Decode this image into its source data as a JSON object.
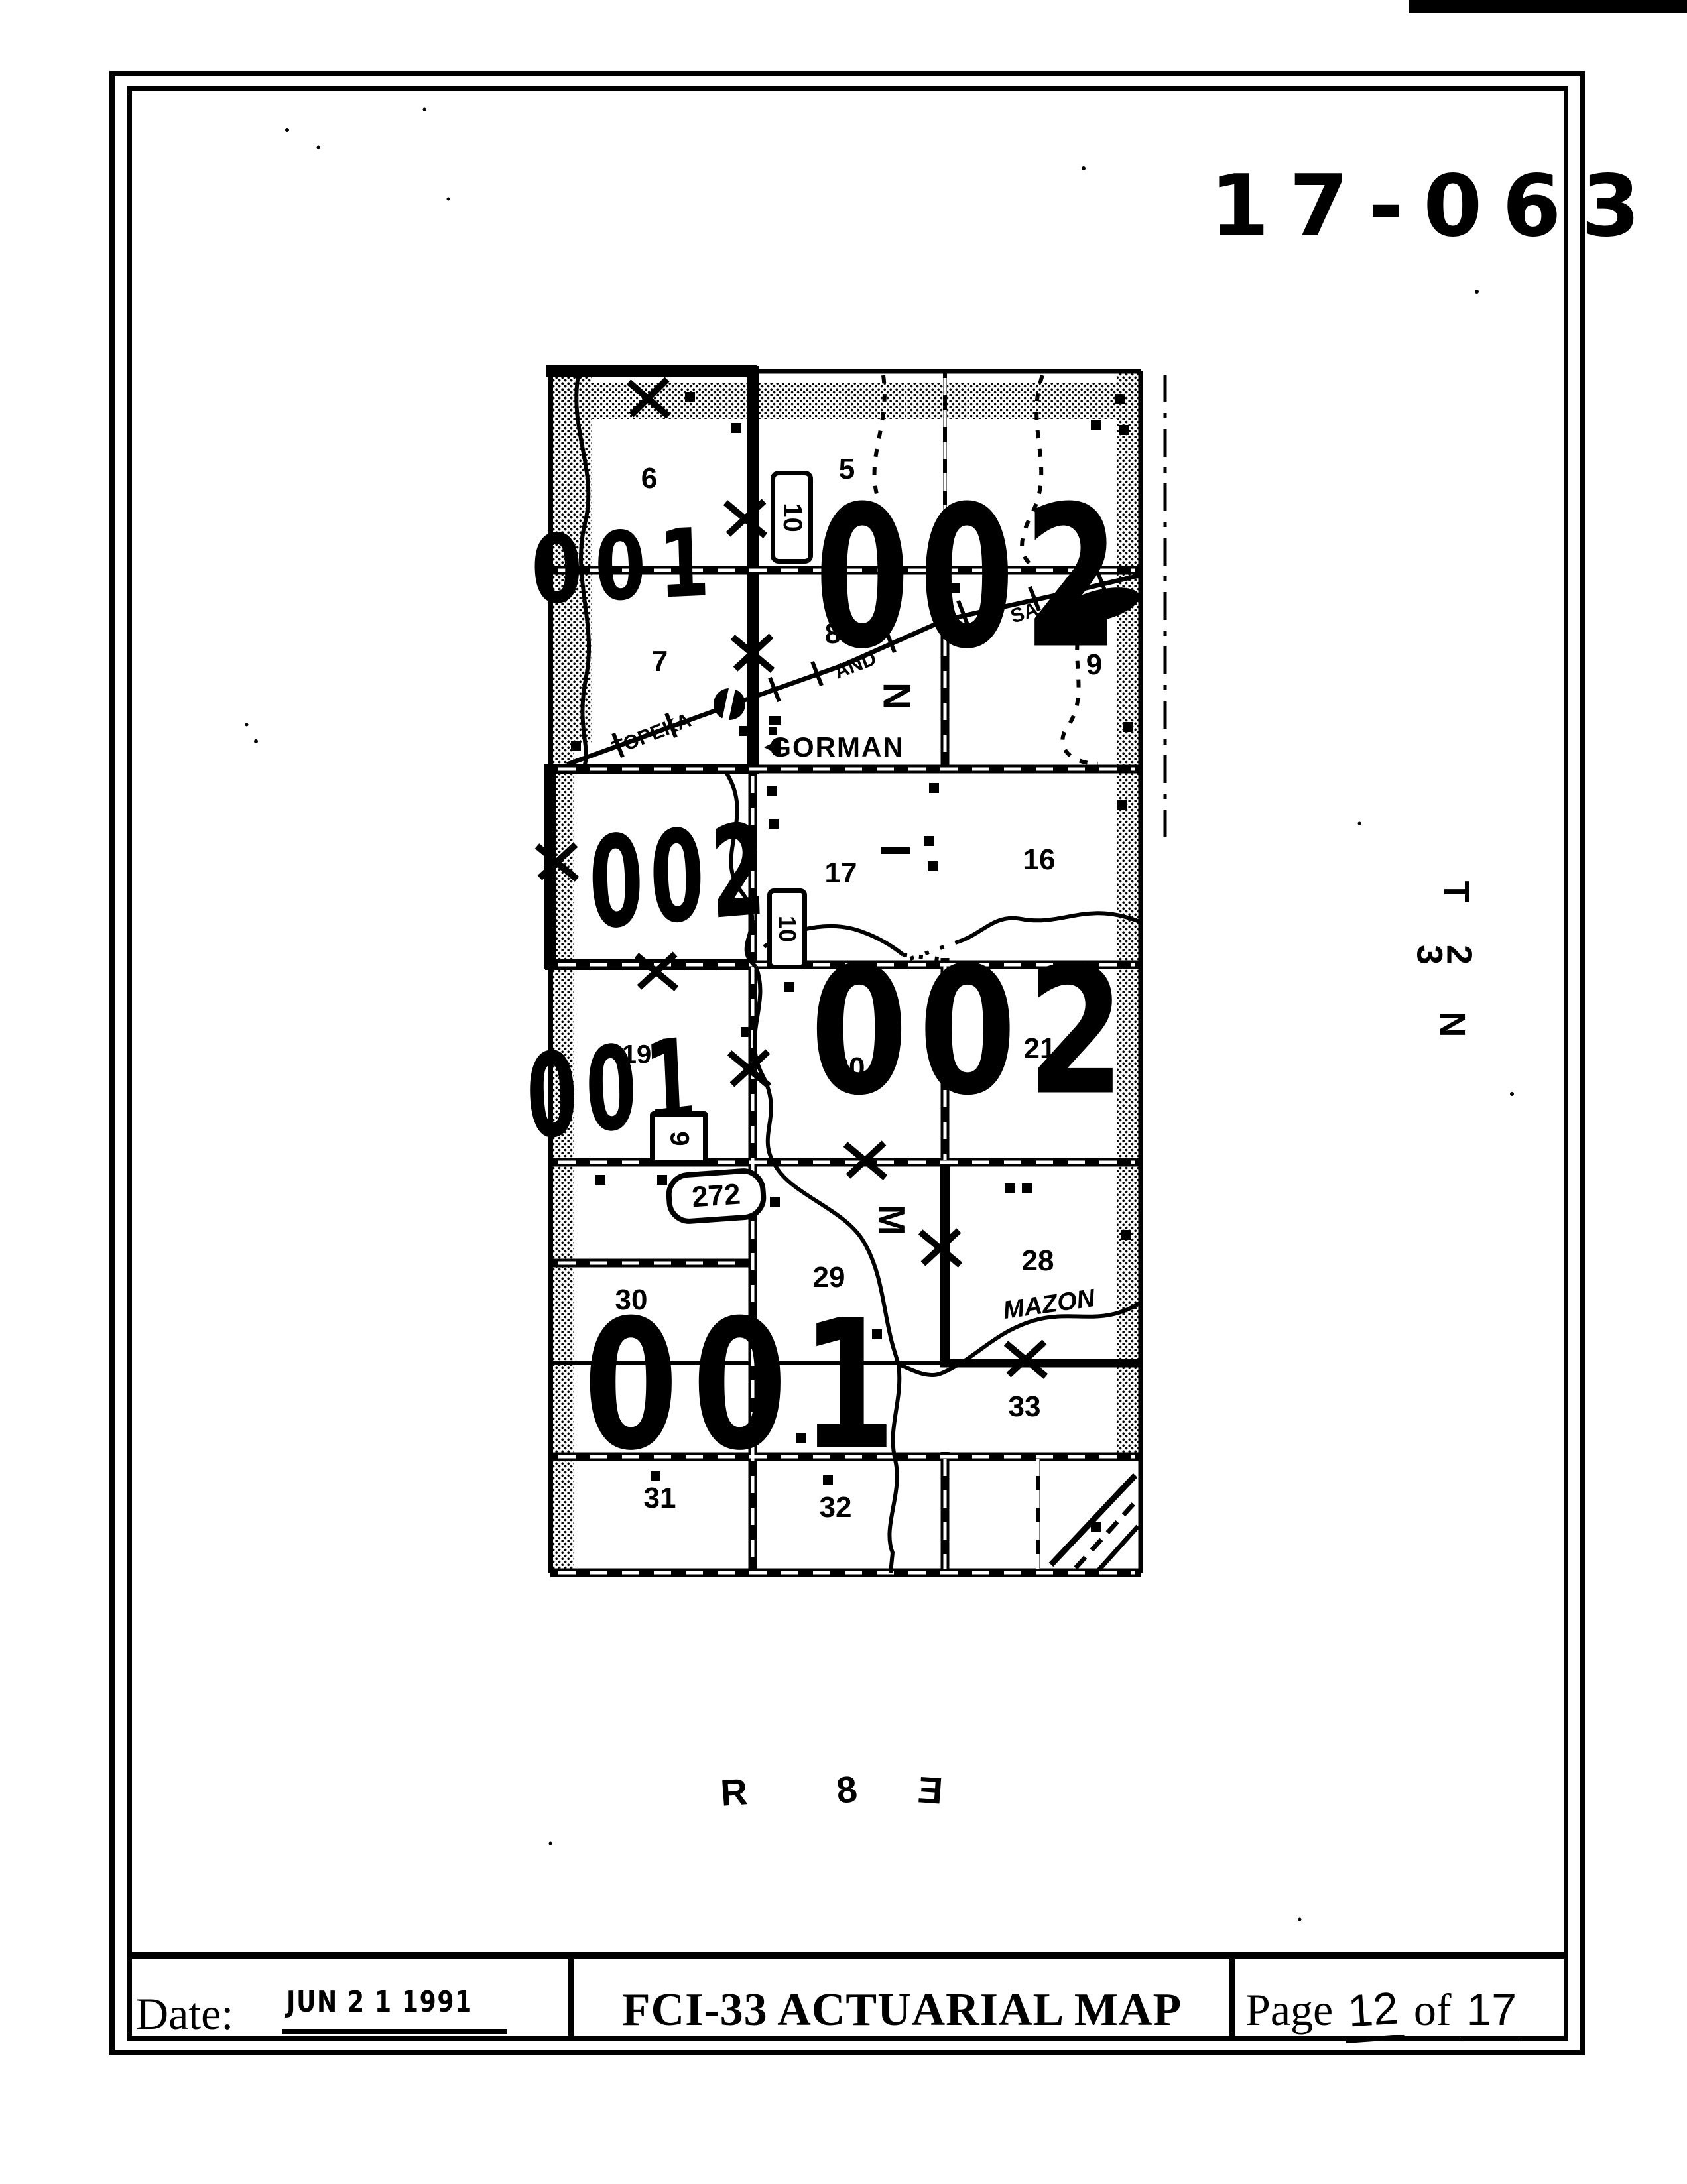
{
  "header": {
    "map_number": "17-063"
  },
  "township_range": {
    "t": "T",
    "township_d1": "3",
    "township_d2": "2",
    "n": "N",
    "r": "R",
    "range": "8",
    "e": "E"
  },
  "map": {
    "sections": [
      {
        "num": "6"
      },
      {
        "num": "5"
      },
      {
        "num": "7"
      },
      {
        "num": "8"
      },
      {
        "num": "9"
      },
      {
        "num": "17"
      },
      {
        "num": "16"
      },
      {
        "num": "19"
      },
      {
        "num": "20"
      },
      {
        "num": "21"
      },
      {
        "num": "30"
      },
      {
        "num": "29"
      },
      {
        "num": "28"
      },
      {
        "num": "33"
      },
      {
        "num": "31"
      },
      {
        "num": "32"
      }
    ],
    "area_stamps": [
      {
        "id": "area-001-northwest",
        "text": "001"
      },
      {
        "id": "area-002-north",
        "text": "002"
      },
      {
        "id": "area-002-west",
        "text": "002"
      },
      {
        "id": "area-001-west",
        "text": "001"
      },
      {
        "id": "area-002-central",
        "text": "002"
      },
      {
        "id": "area-001-south",
        "text": "001"
      }
    ],
    "places": {
      "gorman": "GORMAN",
      "mazon": "MAZON"
    },
    "railroad_name": {
      "w1": "TOPEKA",
      "w2": "AND",
      "w3": "SA"
    },
    "shields": {
      "s10a": "10",
      "s10b": "10",
      "s9": "9",
      "r272": "272"
    },
    "letters": {
      "n": "N",
      "m": "M"
    }
  },
  "footer": {
    "date_label": "Date:",
    "date_stamp": "JUN 2 1 1991",
    "title": "FCI-33 ACTUARIAL MAP",
    "page_word": "Page",
    "page_number": "12",
    "of_word": "of",
    "total_pages": "17"
  }
}
